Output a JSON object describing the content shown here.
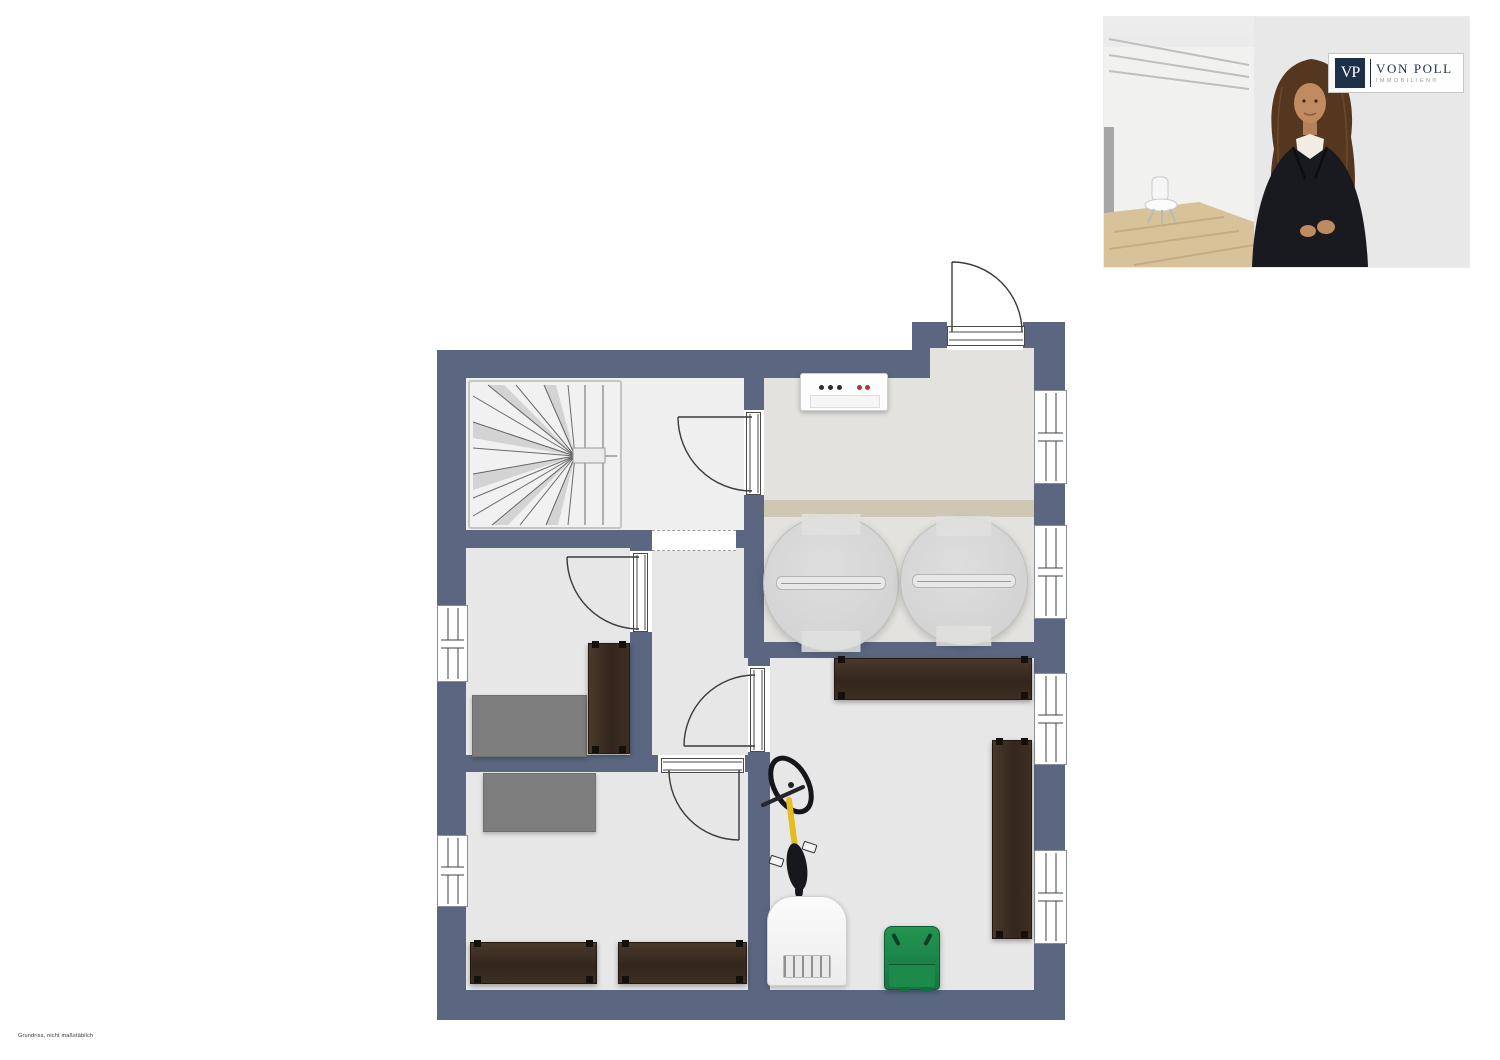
{
  "branding": {
    "vp_initials": "VP",
    "brand_name": "VON POLL",
    "brand_sub": "IMMOBILIEN®"
  },
  "footer": {
    "disclaimer": "Grundriss, nicht maßstäblich"
  },
  "colors": {
    "wall": "#5b6780",
    "floor": "#e7e7e7",
    "floor_light": "#efefef",
    "floor_warm": "#e3e2de",
    "wood_dark": "#38291d",
    "mat_gray": "#7d7d7d",
    "tan": "#cdc7b4",
    "tank": "#d8d8d8",
    "green": "#1f8a4d",
    "bike_yellow": "#e7bc1e",
    "navy": "#1d3049"
  },
  "floorplan": {
    "objects": [
      "winder-staircase",
      "entrance-door",
      "interior-door",
      "interior-door",
      "interior-door",
      "interior-door",
      "open-passage",
      "heating-control-panel",
      "storage-tank",
      "storage-tank",
      "window",
      "window",
      "window",
      "window",
      "window",
      "window",
      "sideboard",
      "sideboard",
      "sideboard",
      "sideboard",
      "sideboard",
      "floor-mat",
      "floor-mat",
      "bicycle",
      "freezer",
      "green-bin"
    ]
  }
}
